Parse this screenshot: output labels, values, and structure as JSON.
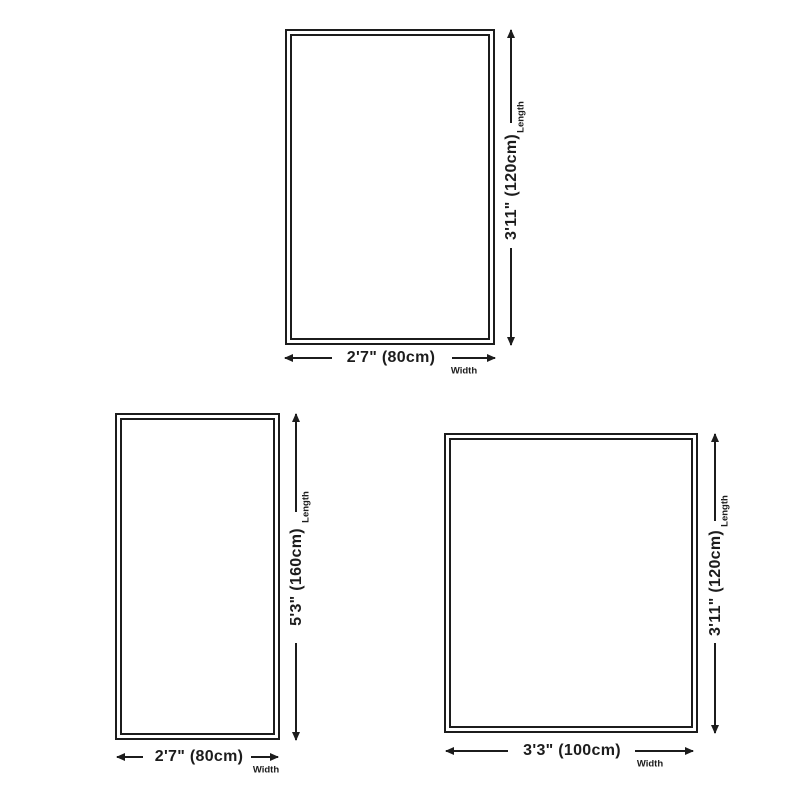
{
  "page": {
    "background_color": "#ffffff",
    "line_color": "#1c1c1c"
  },
  "diagrams": [
    {
      "id": "rug-size-120x80",
      "length_text": "3'11\" (120cm)",
      "width_text": "2'7\" (80cm)",
      "length_label": "Length",
      "width_label": "Width"
    },
    {
      "id": "rug-size-160x80",
      "length_text": "5'3\" (160cm)",
      "width_text": "2'7\" (80cm)",
      "length_label": "Length",
      "width_label": "Width"
    },
    {
      "id": "rug-size-120x100",
      "length_text": "3'11\" (120cm)",
      "width_text": "3'3\" (100cm)",
      "length_label": "Length",
      "width_label": "Width"
    }
  ]
}
